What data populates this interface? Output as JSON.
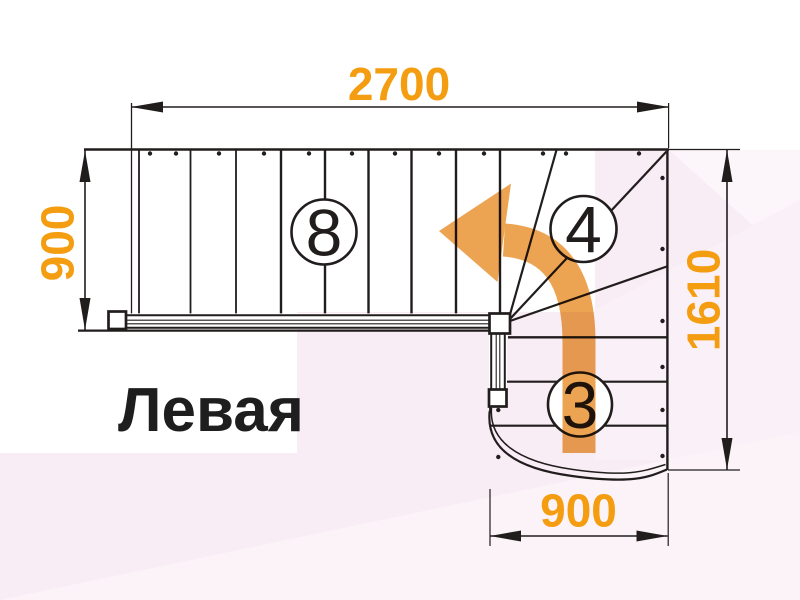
{
  "title": {
    "text": "Левая"
  },
  "dimensions": {
    "top": "2700",
    "left": "900",
    "right": "1610",
    "bottom": "900"
  },
  "labels": {
    "upper_flight_steps": "8",
    "winder_steps": "4",
    "lower_flight_steps": "3"
  },
  "colors": {
    "dimension_text": "#f49d10",
    "arrow_orange": "#eca452",
    "line_dark": "#211d1c",
    "pink_base": "#f8ecf5",
    "pink_light": "#fbf3f8",
    "background": "#ffffff"
  }
}
